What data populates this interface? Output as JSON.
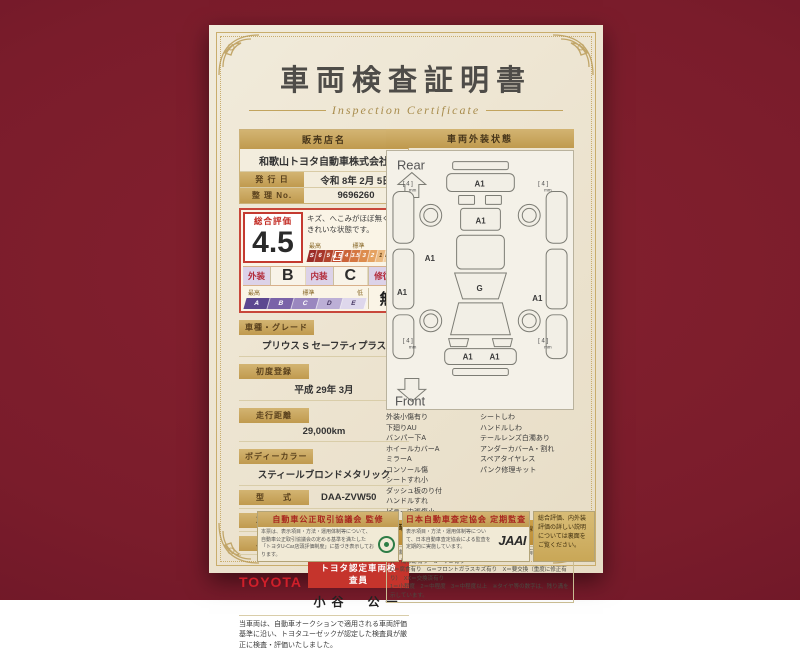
{
  "certificate": {
    "title": "車両検査証明書",
    "subtitle": "Inspection Certificate",
    "dealer": {
      "header": "販売店名",
      "name": "和歌山トヨタ自動車株式会社",
      "issue_label": "発 行 日",
      "issue_value": "令和 8年 2月 5日",
      "serial_label": "整 理 No.",
      "serial_value": "9696260"
    },
    "rating": {
      "overall_label": "総合評価",
      "overall_value": "4.5",
      "comment": "キズ、へこみがほぼ無く、きれいな状態です。",
      "scale_high": "最高",
      "scale_mid": "標準",
      "scale_low": "低",
      "scale": [
        "S",
        "6",
        "5",
        "4.5",
        "4",
        "3.5",
        "3",
        "2",
        "1",
        "RA",
        "R"
      ],
      "exterior_label": "外装",
      "exterior_value": "B",
      "interior_label": "内装",
      "interior_value": "C",
      "repair_label": "修復歴",
      "repair_value": "無",
      "grade_scale": [
        "A",
        "B",
        "C",
        "D",
        "E"
      ]
    },
    "vehicle": {
      "fields": [
        {
          "label": "車種・グレード",
          "value": "プリウス S セーフティプラス"
        },
        {
          "label": "初度登録",
          "value": "平成 29年 3月"
        },
        {
          "label": "走行距離",
          "value": "29,000km"
        },
        {
          "label": "ボディーカラー",
          "value": "スティールブロンドメタリック"
        },
        {
          "label": "型　　式",
          "value": "DAA-ZVW50"
        },
        {
          "label": "車台番号",
          "value": "XXXXXXX931"
        },
        {
          "label": "エンジン",
          "value": "ハイブリッド"
        }
      ]
    },
    "inspector": {
      "brand": "TOYOTA",
      "badge": "トヨタ認定車両検査員",
      "name": "小谷　公一"
    },
    "disclaimer": "当車両は、自動車オークションで適用される車両評価基準に沿い、トヨタユーゼックが認定した検査員が厳正に検査・評価いたしました。",
    "exterior_panel": {
      "header": "車両外装状態",
      "rear_label": "Rear",
      "front_label": "Front",
      "mark_a1": "A1",
      "mark_g": "G",
      "wheel_note": "[ 4 ]",
      "wheel_unit": "mm",
      "legend_left": [
        "外装小傷有り",
        "下廻りAU",
        "バンパー下A",
        "ホイールカバーA",
        "ミラーA",
        "コンソール傷",
        "シートすれ小",
        "ダッシュ板のり付",
        "ハンドルすれ",
        "ピラー内張傷小"
      ],
      "legend_right": [
        "シートしわ",
        "ハンドルしわ",
        "テールレンズ白濁あり",
        "アンダーカバーA・割れ",
        "スペアタイヤレス",
        "パンク修理キット"
      ],
      "symbol_header": "車両外装状態の表示記号について",
      "symbol_example": "（例）A1＝線キズ小程度有り",
      "symbol_lines": [
        "A＝線キズ有り　U＝ヘコミ有り　B＝キズを伴うヘコミ有り　P＝要塗装　W＝補修跡有り　S＝サビ有り",
        "C＝腐食有り　G＝フロントガラスキズ有り　X＝要交換（重度に修正有り）　XX＝交換済有り",
        "1＝小程度　2＝中程度　3＝中程度以上　※タイヤ等の数字は、残り溝を示しています。"
      ]
    },
    "footer": {
      "fair_trade_header": "自動車公正取引協議会 監修",
      "fair_trade_body": "本票は、表示項目・方法・運用体制等について、自動車公正取引協議会の定める基準を満たした「トヨタU-Car店頭評価制度」に基づき表示しております。",
      "jaai_header": "日本自動車査定協会 定期監査",
      "jaai_body": "表示項目・方法・運用体制等について、日本自動車査定協会による監査を定期的に実施しています。",
      "jaai_logo": "JAAI",
      "backside_note": "総合評価、内外装評価の詳しい説明については裏面をご覧ください。"
    }
  }
}
